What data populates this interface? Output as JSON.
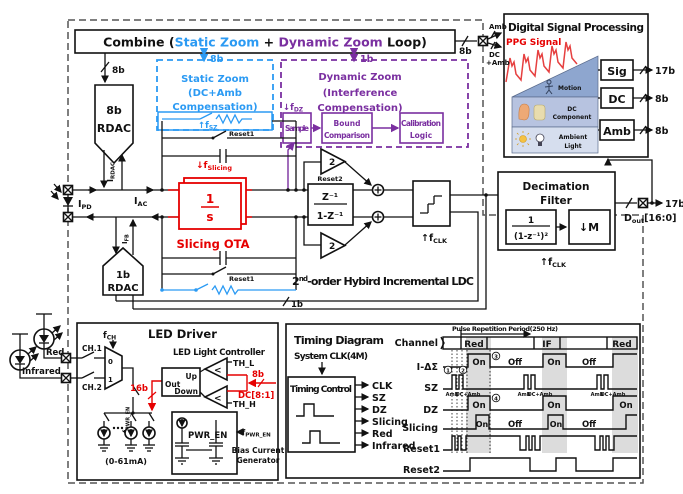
{
  "colors": {
    "accent_blue": "#2b9af3",
    "accent_purple": "#7a2fa0",
    "accent_red": "#e60000"
  },
  "combine": {
    "prefix": "Combine (",
    "static": "Static Zoom",
    "plus": " + ",
    "dynamic": "Dynamic Zoom",
    "suffix": " Loop)",
    "bus_out": "8b",
    "bus_static": "8b",
    "bus_dynamic": "1b",
    "bus_rdac": "8b"
  },
  "pads_in": {
    "amb": "Amb",
    "dc": "DC",
    "dcamb": "+Amb"
  },
  "rdac8": {
    "bits": "8b",
    "name": "RDAC",
    "i_base": "I",
    "i_sub": "RDAC"
  },
  "pd": {
    "ipd_base": "I",
    "ipd_sub": "PD",
    "iac_base": "I",
    "iac_sub": "AC"
  },
  "rdac1": {
    "bits": "1b",
    "name": "RDAC",
    "i_base": "I",
    "i_sub": "FB"
  },
  "static_zoom": {
    "l1": "Static Zoom",
    "l2": "(DC+Amb",
    "l3": "Compensation)",
    "fsz_arrow": "↑",
    "fsz_base": "f",
    "fsz_sub": "SZ"
  },
  "dynamic_zoom": {
    "l1": "Dynamic Zoom",
    "l2": "(Interference",
    "l3": "Compensation)",
    "fdz_arrow": "↓",
    "fdz_base": "f",
    "fdz_sub": "DZ",
    "sample": "Sample",
    "bound1": "Bound",
    "bound2": "Comparison",
    "cal1": "Calibration",
    "cal2": "Logic"
  },
  "ota": {
    "num": "1",
    "den": "s",
    "name": "Slicing OTA",
    "fsl_arrow": "↓",
    "fsl_base": "f",
    "fsl_sub": "Slicing",
    "reset_top": "Reset1",
    "reset_bot": "Reset1"
  },
  "integ": {
    "reset": "Reset2",
    "num": "Z⁻¹",
    "den": "1-Z⁻¹",
    "gain_top": "2",
    "gain_bot": "2"
  },
  "quant": {
    "fclk_arrow": "↑",
    "fclk_base": "f",
    "fclk_sub": "CLK"
  },
  "ldc": {
    "base": "2",
    "sup": "nd",
    "rest": "-order Hybird Incremental LDC",
    "fb_bus": "1b"
  },
  "decim": {
    "l1": "Decimation",
    "l2": "Filter",
    "num": "1",
    "den": "(1-z⁻¹)²",
    "down_arrow": "↓",
    "down_m": "M",
    "fclk_arrow": "↑",
    "fclk_base": "f",
    "fclk_sub": "CLK"
  },
  "dout": {
    "bus": "17b",
    "base": "D",
    "sub": "out",
    "rest": "[16:0]"
  },
  "dsp": {
    "title": "Digital Signal Processing",
    "ppg": "PPG Signal",
    "motion": "Motion",
    "dc1": "DC",
    "dc2": "Component",
    "amb1": "Ambient",
    "amb2": "Light",
    "sig": "Sig",
    "dc": "DC",
    "amb": "Amb",
    "sig_bus": "17b",
    "dc_bus": "8b",
    "amb_bus": "8b"
  },
  "led": {
    "title": "LED Driver",
    "fch_base": "f",
    "fch_sub": "CH",
    "ch1": "CH.1",
    "ch2": "CH.2",
    "red": "Red",
    "infrared": "Infrared",
    "mux0": "0",
    "mux1": "1",
    "fpwr_base": "f",
    "fpwr_sub": "PWR_EN",
    "bus16": "16b",
    "range": "(0-61mA)",
    "controller": "LED Light Controller",
    "up": "Up",
    "out": "Out",
    "down": "Down",
    "lt": "<",
    "thl": "TH_L",
    "thh": "TH_H",
    "bus8": "8b",
    "dc81": "DC[8:1]",
    "pwren": "PWR_EN",
    "fpwr2_base": "f",
    "fpwr2_sub": "PWR_EN",
    "bias1": "Bias Current",
    "bias2": "Generator"
  },
  "timing": {
    "title": "Timing Diagram",
    "sysclk": "System CLK(4M)",
    "control": "Timing Control",
    "sig1": "CLK",
    "sig2": "SZ",
    "sig3": "DZ",
    "sig4": "Slicing",
    "sig5": "Red",
    "sig6": "Infrared",
    "prp": "Pulse Repetition Period(250 Hz)",
    "row_channel": "Channel",
    "row_ids": "I-ΔΣ",
    "row_sz": "SZ",
    "row_dz": "DZ",
    "row_slicing": "Slicing",
    "row_reset1": "Reset1",
    "row_reset2": "Reset2",
    "ch_red": "Red",
    "ch_if": "IF",
    "ch_red2": "Red",
    "on": "On",
    "off": "Off",
    "amb": "Amb",
    "dcamb": "DC+Amb",
    "n1": "1",
    "n2": "2",
    "n3": "3",
    "n4": "4"
  }
}
